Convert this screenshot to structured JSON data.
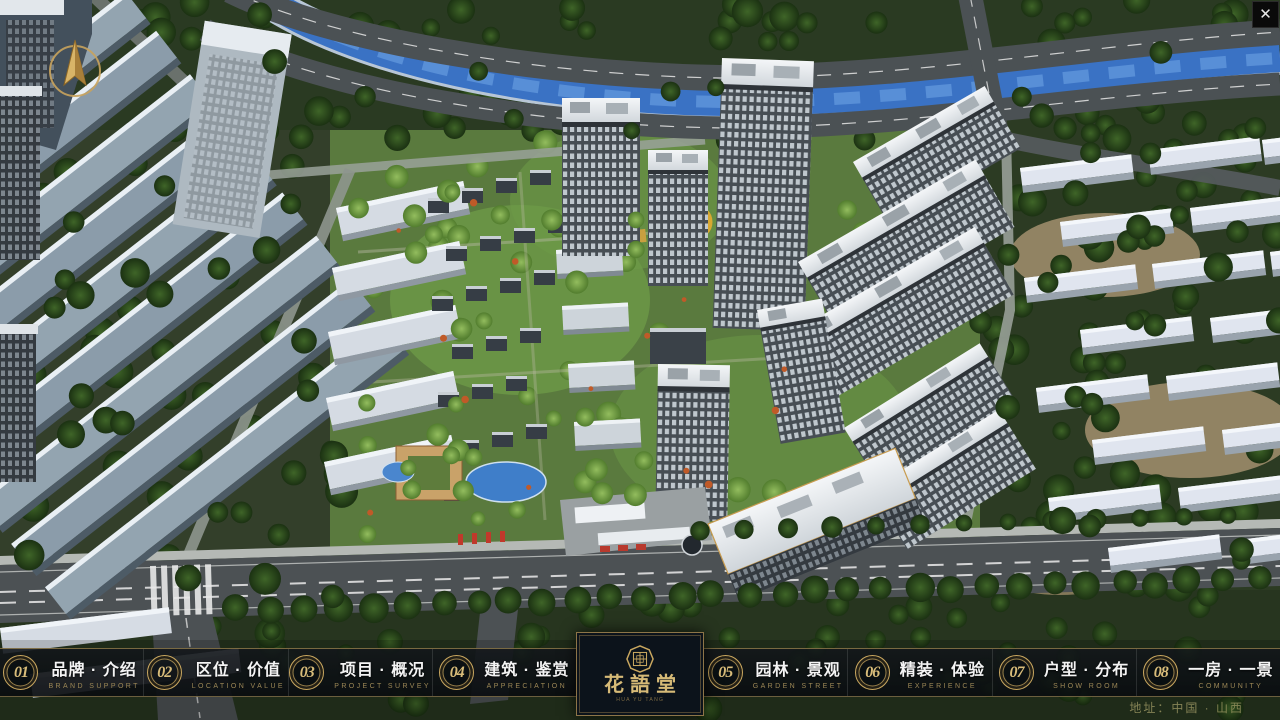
{
  "window": {
    "close_label": "✕"
  },
  "icons": {
    "close": "close-x",
    "compass": "compass-north-arrow",
    "logo_seal": "octagon-seal"
  },
  "nav": {
    "items": [
      {
        "num": "01",
        "label": "品牌 · 介绍",
        "sub": "BRAND SUPPORT"
      },
      {
        "num": "02",
        "label": "区位 · 价值",
        "sub": "LOCATION VALUE"
      },
      {
        "num": "03",
        "label": "项目 · 概况",
        "sub": "PROJECT SURVEY"
      },
      {
        "num": "04",
        "label": "建筑 · 鉴赏",
        "sub": "APPRECIATION"
      },
      {
        "num": "05",
        "label": "园林 · 景观",
        "sub": "GARDEN STREET"
      },
      {
        "num": "06",
        "label": "精装 · 体验",
        "sub": "EXPERIENCE"
      },
      {
        "num": "07",
        "label": "户型 · 分布",
        "sub": "SHOW ROOM"
      },
      {
        "num": "08",
        "label": "一房 · 一景",
        "sub": "COMMUNITY"
      }
    ]
  },
  "logo": {
    "title": "花語堂",
    "subtitle": "HUA YU TANG"
  },
  "footer": {
    "address": "地址：中国 · 山西"
  },
  "colors": {
    "gold": "#c9a75f",
    "gold_text": "#d6ba77",
    "bar_bg": "rgba(13,17,21,0.85)",
    "sub_text": "#9c8756"
  }
}
